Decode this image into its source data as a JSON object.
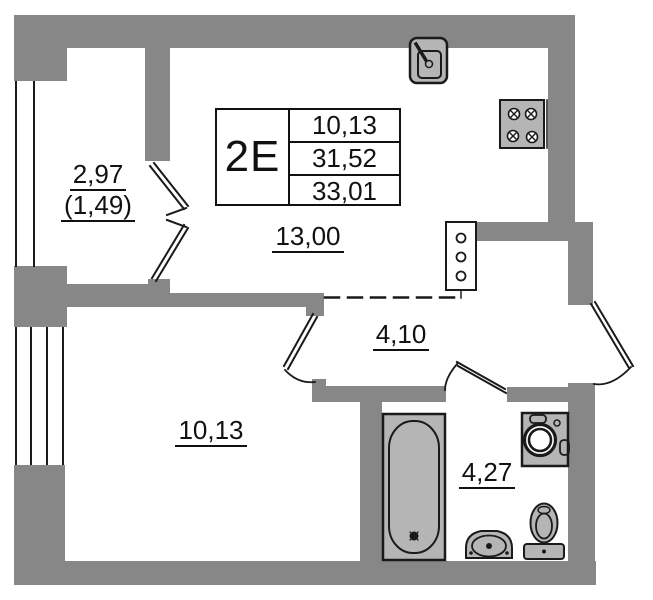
{
  "plan": {
    "unit_card": {
      "type_label": "2Е",
      "values": [
        "10,13",
        "31,52",
        "33,01"
      ]
    },
    "labels": {
      "balcony_area": "2,97",
      "balcony_area_reduced": "(1,49)",
      "kitchen_living_area": "13,00",
      "hallway_area": "4,10",
      "bedroom_area": "10,13",
      "bathroom_area": "4,27"
    },
    "icons": {
      "kitchen_sink": "kitchen-sink-icon",
      "stove": "stove-icon",
      "plumbing_shaft": "plumbing-shaft-icon",
      "bathtub": "bathtub-icon",
      "washing_machine": "washing-machine-icon",
      "washbasin": "washbasin-icon",
      "toilet": "toilet-icon"
    },
    "colors": {
      "wall": "#878787",
      "fixture": "#b5b5b5",
      "line": "#1a1a1a",
      "bg": "#ffffff"
    }
  }
}
